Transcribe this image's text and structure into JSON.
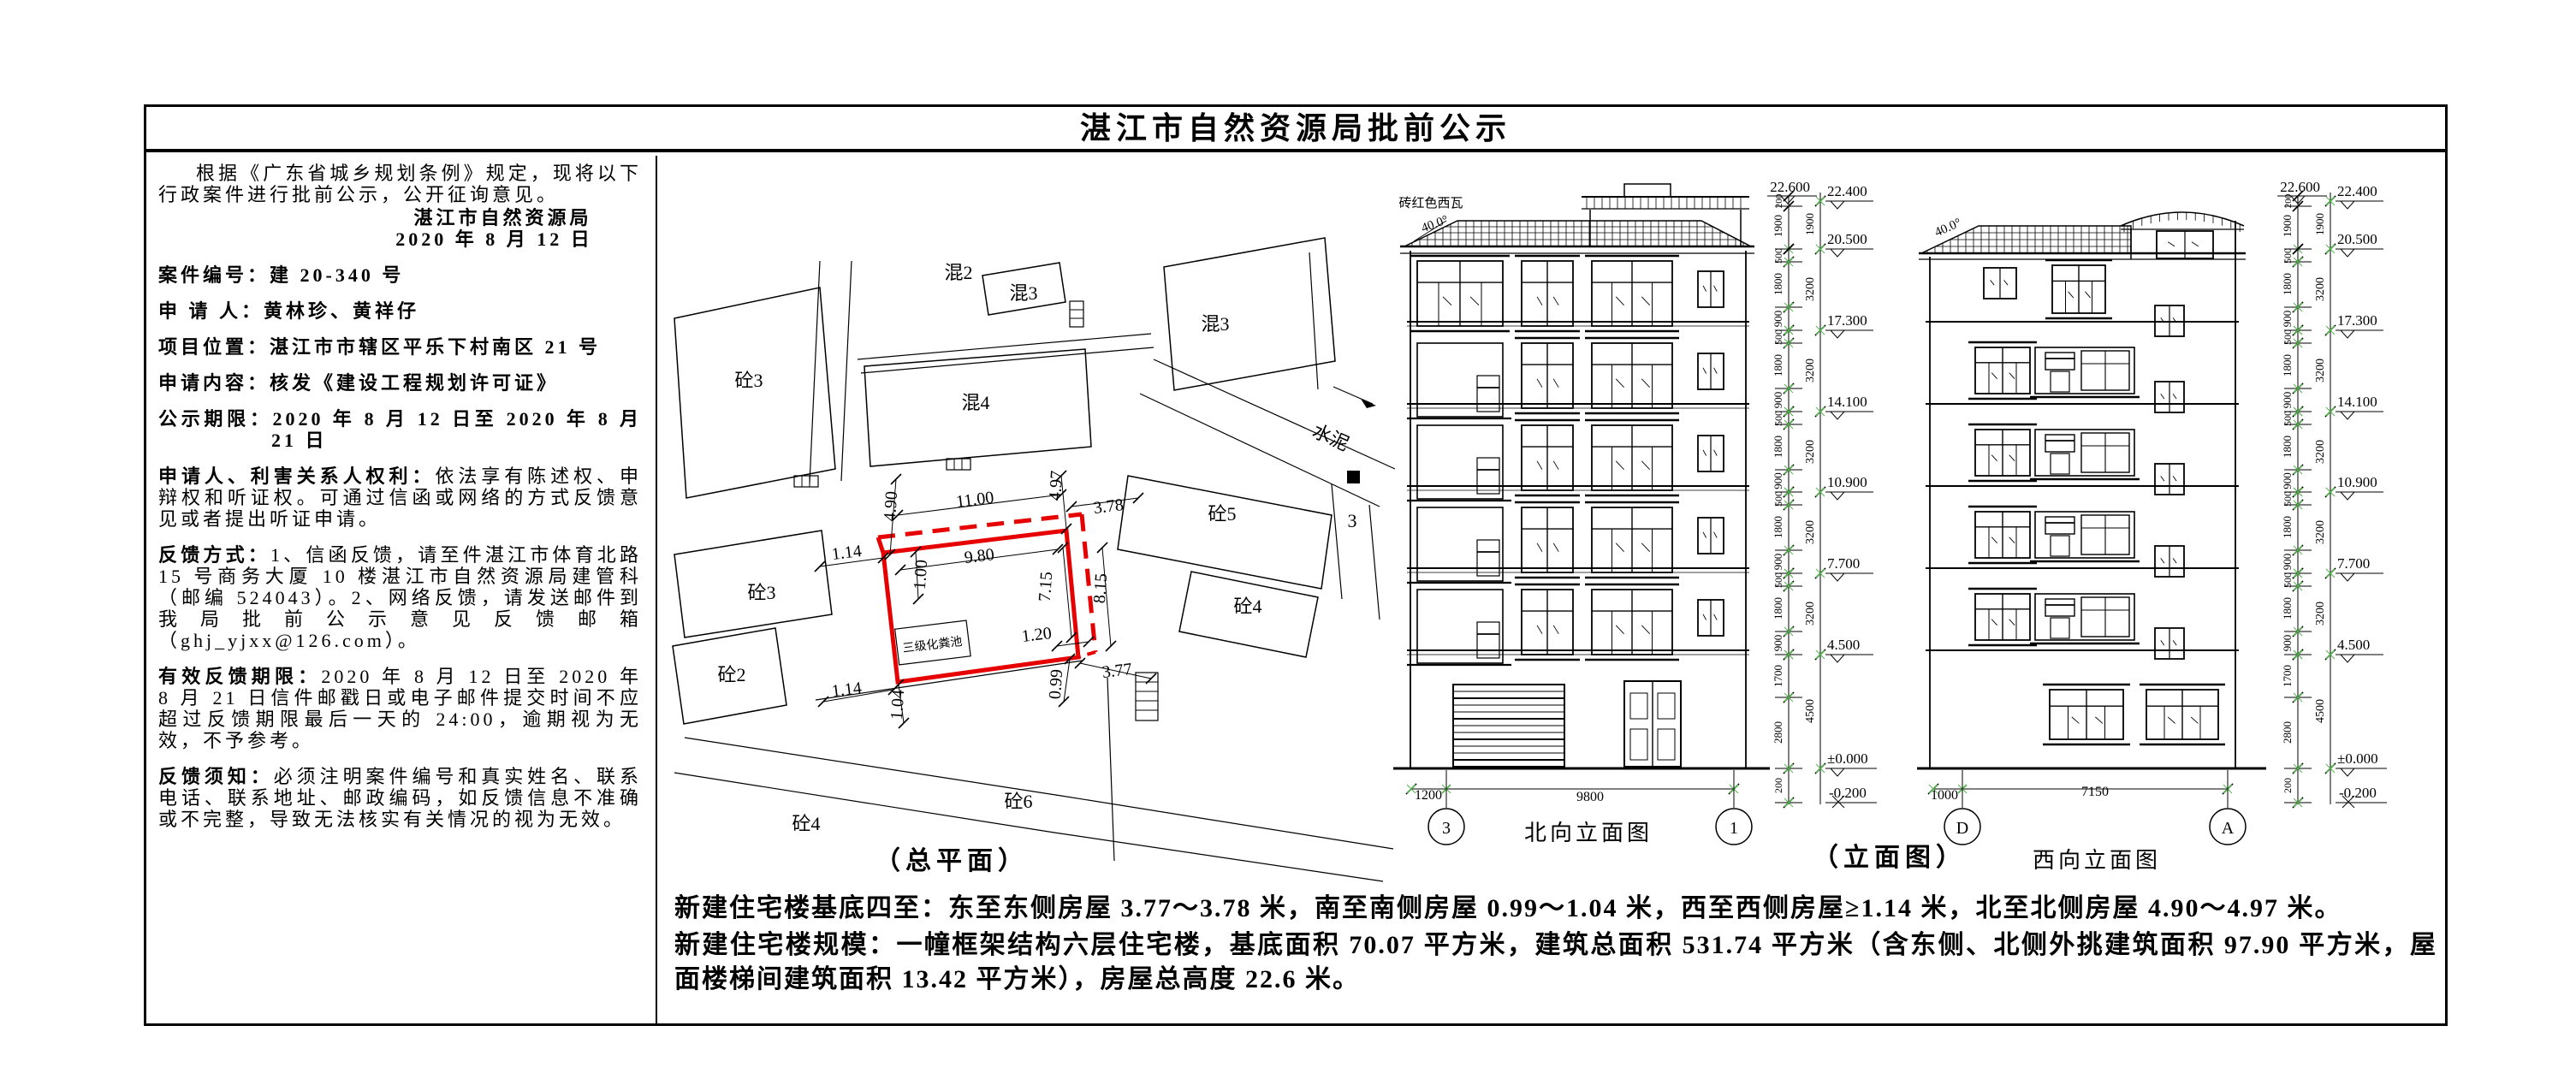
{
  "title": "湛江市自然资源局批前公示",
  "left_panel": {
    "intro": "根据《广东省城乡规划条例》规定，现将以下行政案件进行批前公示，公开征询意见。",
    "agency": "湛江市自然资源局",
    "date": "2020 年 8 月 12 日",
    "fields": [
      {
        "label": "案件编号：",
        "value": "建 20-340 号"
      },
      {
        "label": "申 请 人：",
        "value": "黄林珍、黄祥仔"
      },
      {
        "label": "项目位置：",
        "value": "湛江市市辖区平乐下村南区 21 号"
      },
      {
        "label": "申请内容：",
        "value": "核发《建设工程规划许可证》"
      },
      {
        "label": "公示期限：",
        "value": "2020 年 8 月 12 日至 2020 年 8 月 21 日"
      },
      {
        "label": "申请人、利害关系人权利：",
        "value": "依法享有陈述权、申辩权和听证权。可通过信函或网络的方式反馈意见或者提出听证申请。"
      },
      {
        "label": "反馈方式：",
        "value": "1、信函反馈，请至件湛江市体育北路 15 号商务大厦 10 楼湛江市自然资源局建管科（邮编 524043）。2、网络反馈，请发送邮件到我局批前公示意见反馈邮箱（ghj_yjxx@126.com）。"
      },
      {
        "label": "有效反馈期限：",
        "value": "2020 年 8 月 12 日至 2020 年 8 月 21 日信件邮戳日或电子邮件提交时间不应超过反馈期限最后一天的 24:00，逾期视为无效，不予参考。"
      },
      {
        "label": "反馈须知：",
        "value": "必须注明案件编号和真实姓名、联系电话、联系地址、邮政编码，如反馈信息不准确或不完整，导致无法核实有关情况的视为无效。"
      }
    ]
  },
  "site_plan": {
    "caption": "（总平面）",
    "septic_tank": "三级化粪池",
    "road_cement": "水泥",
    "road_no": "3",
    "buildings": {
      "hun2": "混2",
      "hun3a": "混3",
      "tong3a": "砼3",
      "hun4": "混4",
      "hun3b": "混3",
      "tong5": "砼5",
      "tong2": "砼2",
      "tong3b": "砼3",
      "tong4a": "砼4",
      "tong6": "砼6",
      "tong4b": "砼4"
    },
    "dims": {
      "n_w": "4.90",
      "n_total": "11.00",
      "n_e": "4.97",
      "e_n": "3.78",
      "w_upper": "1.14",
      "w_inner": "1.00",
      "inner_w": "9.80",
      "inner_d": "7.15",
      "overhang_d": "8.15",
      "e_corner": "1.20",
      "w_lower": "1.14",
      "s_w": "1.04",
      "s_e": "0.99",
      "e_s": "3.77"
    }
  },
  "elevations": {
    "caption": "（立面图）",
    "north": {
      "name": "北向立面图",
      "roof_note": "砖红色西瓦",
      "roof_angle": "40.0°",
      "axis_l": "3",
      "axis_r": "1",
      "dim_l": "1200",
      "dim_w": "9800"
    },
    "west": {
      "name": "西向立面图",
      "roof_angle": "40.0°",
      "axis_l": "D",
      "axis_r": "A",
      "dim_l": "1000",
      "dim_w": "7150"
    },
    "levels": [
      "22.600",
      "22.400",
      "20.500",
      "17.300",
      "14.100",
      "10.900",
      "7.700",
      "4.500",
      "±0.000",
      "-0.200"
    ],
    "floor_dims": [
      "500",
      "1800",
      "900"
    ],
    "floor_total": "3200",
    "top_dims": [
      "200",
      "1900"
    ],
    "bottom_dims": [
      "1700",
      "2800"
    ],
    "bottom_total": "4500",
    "base_dim": "200"
  },
  "bottom": {
    "p1_label": "新建住宅楼基底四至：",
    "p1_text": "东至东侧房屋 3.77～3.78 米，南至南侧房屋 0.99～1.04 米，西至西侧房屋≥1.14 米，北至北侧房屋 4.90～4.97 米。",
    "p2_label": "新建住宅楼规模：",
    "p2_text": "一幢框架结构六层住宅楼，基底面积 70.07 平方米，建筑总面积 531.74 平方米（含东侧、北侧外挑建筑面积 97.90 平方米，屋面楼梯间建筑面积 13.42 平方米），房屋总高度 22.6 米。"
  },
  "colors": {
    "highlight": "#e60000",
    "tick_green": "#55b24e"
  }
}
